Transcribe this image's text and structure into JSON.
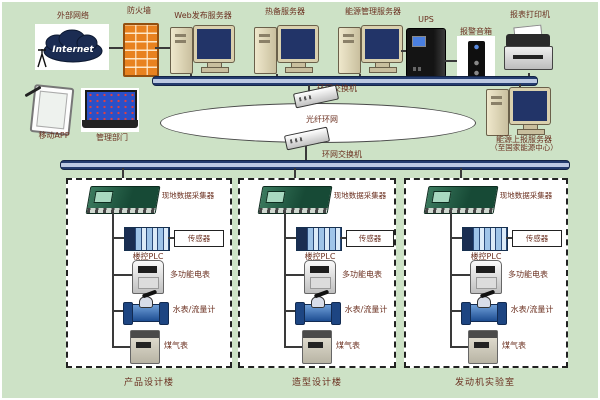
{
  "top_row": {
    "external_network_label": "外部网络",
    "internet_text": "Internet",
    "firewall_label": "防火墙",
    "web_server_label": "Web发布服务器",
    "standby_server_label": "热备服务器",
    "energy_server_label": "能源管理服务器",
    "ups_label": "UPS",
    "alarm_speaker_label": "报警音箱",
    "printer_label": "报表打印机"
  },
  "clients": {
    "mobile_app_label": "移动APP",
    "management_label": "管理部门"
  },
  "ring": {
    "top_switch_label": "环网交换机",
    "fiber_ring_label": "光纤环网",
    "bottom_switch_label": "环网交换机"
  },
  "report_server": {
    "line1": "能源上报服务器",
    "line2": "（至国家能源中心）"
  },
  "sections": [
    {
      "collector_label": "现地数据采集器",
      "sensor_label": "传感器",
      "plc_label": "楼控PLC",
      "power_meter_label": "多功能电表",
      "water_meter_label": "水表/流量计",
      "gas_meter_label": "煤气表",
      "building_label": "产品设计楼"
    },
    {
      "collector_label": "现地数据采集器",
      "sensor_label": "传感器",
      "plc_label": "楼控PLC",
      "power_meter_label": "多功能电表",
      "water_meter_label": "水表/流量计",
      "gas_meter_label": "煤气表",
      "building_label": "造型设计楼"
    },
    {
      "collector_label": "现地数据采集器",
      "sensor_label": "传感器",
      "plc_label": "楼控PLC",
      "power_meter_label": "多功能电表",
      "water_meter_label": "水表/流量计",
      "gas_meter_label": "煤气表",
      "building_label": "发动机实验室"
    }
  ],
  "colors": {
    "background": "#cde2c6",
    "label_text": "#6b3020",
    "bus_fill": "#bcc9e2",
    "bus_edge": "#243c6e",
    "collector_green": "#1e5c43",
    "water_meter_blue": "#1d4d92",
    "firewall_orange": "#e8821f",
    "monitor_screen": "#223468"
  }
}
